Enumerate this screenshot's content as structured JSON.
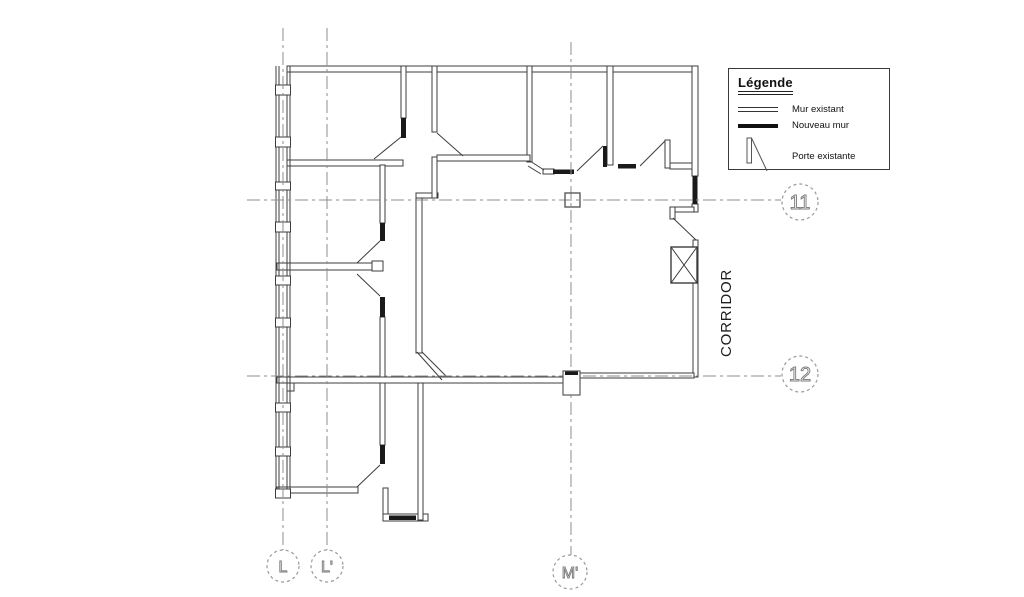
{
  "legend": {
    "title": "Légende",
    "items": [
      {
        "id": "existing-wall",
        "label": "Mur existant"
      },
      {
        "id": "new-wall",
        "label": "Nouveau mur"
      },
      {
        "id": "existing-door",
        "label": "Porte existante"
      }
    ]
  },
  "plan": {
    "corridor_label": "CORRIDOR"
  },
  "grid_markers": {
    "row_11": "11",
    "row_12": "12",
    "col_L": "L",
    "col_L_prime": "L'",
    "col_M_prime": "M'"
  },
  "colors": {
    "wall_line": "#3d3d3d",
    "new_wall": "#1a1a1a",
    "grid_line": "#8c8c8c",
    "bubble_line": "#9a9a9a",
    "background": "#ffffff"
  }
}
